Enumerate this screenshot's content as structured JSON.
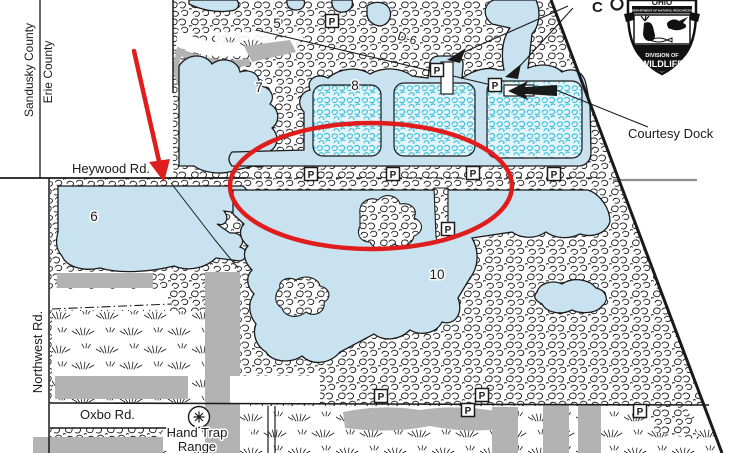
{
  "colors": {
    "water": "#c9e2f0",
    "marsh_cyan": "#35bfdd",
    "marsh_bg": "#e4f4f9",
    "gray": "#b3b3b3",
    "road_gray": "#8f8f8f",
    "ink": "#1a1a1a",
    "annotation_red": "#e01d1d"
  },
  "labels": {
    "sandusky_county": "Sandusky County",
    "erie_county": "Erie County",
    "heywood_rd": "Heywood Rd.",
    "northwest_rd": "Northwest Rd.",
    "oxbo_rd": "Oxbo Rd.",
    "hand_trap_line1": "Hand Trap",
    "hand_trap_line2": "Range",
    "courtesy_dock": "Courtesy Dock",
    "dike_label": "D-6",
    "top_cutoff_label": "C"
  },
  "ponds": [
    {
      "number": "5",
      "x": 277,
      "y": 28
    },
    {
      "number": "6",
      "x": 94,
      "y": 221
    },
    {
      "number": "7",
      "x": 259,
      "y": 92
    },
    {
      "number": "8",
      "x": 355,
      "y": 90
    },
    {
      "number": "10",
      "x": 437,
      "y": 279
    }
  ],
  "parking": {
    "symbol": "P",
    "spots": [
      {
        "x": 332,
        "y": 21
      },
      {
        "x": 437,
        "y": 70
      },
      {
        "x": 495,
        "y": 85
      },
      {
        "x": 311,
        "y": 174
      },
      {
        "x": 393,
        "y": 174
      },
      {
        "x": 473,
        "y": 173
      },
      {
        "x": 554,
        "y": 174
      },
      {
        "x": 448,
        "y": 229
      },
      {
        "x": 381,
        "y": 396
      },
      {
        "x": 482,
        "y": 395
      },
      {
        "x": 468,
        "y": 410
      },
      {
        "x": 640,
        "y": 411
      }
    ]
  },
  "badge": {
    "top_text": "OHIO",
    "banner_text": "DEPARTMENT OF NATURAL RESOURCES",
    "division_line1": "DIVISION OF",
    "division_line2": "WILDLIFE"
  }
}
